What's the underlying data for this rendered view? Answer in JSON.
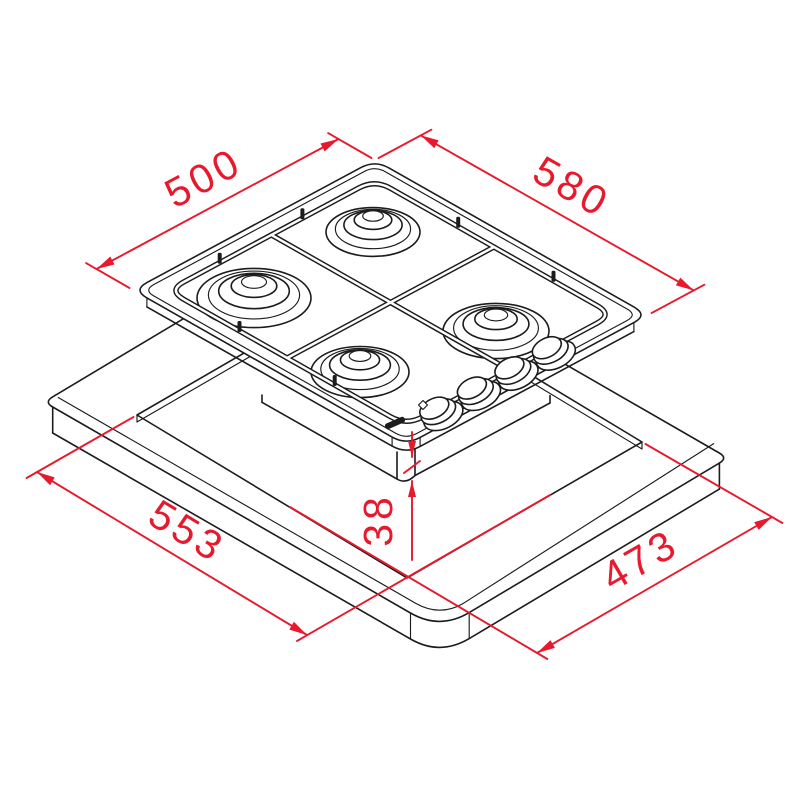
{
  "drawing": {
    "title": "gas-hob-installation-dimension-diagram",
    "units": "mm",
    "line_color": "#1c1c1c",
    "dimension_color": "#e8192d",
    "background": "#ffffff",
    "hob": {
      "burner_count": 4,
      "control_knob_count": 4
    },
    "dimensions": {
      "hob_depth": "500",
      "hob_width": "580",
      "cutout_width": "553",
      "cutout_depth": "473",
      "recess_depth": "38"
    }
  }
}
